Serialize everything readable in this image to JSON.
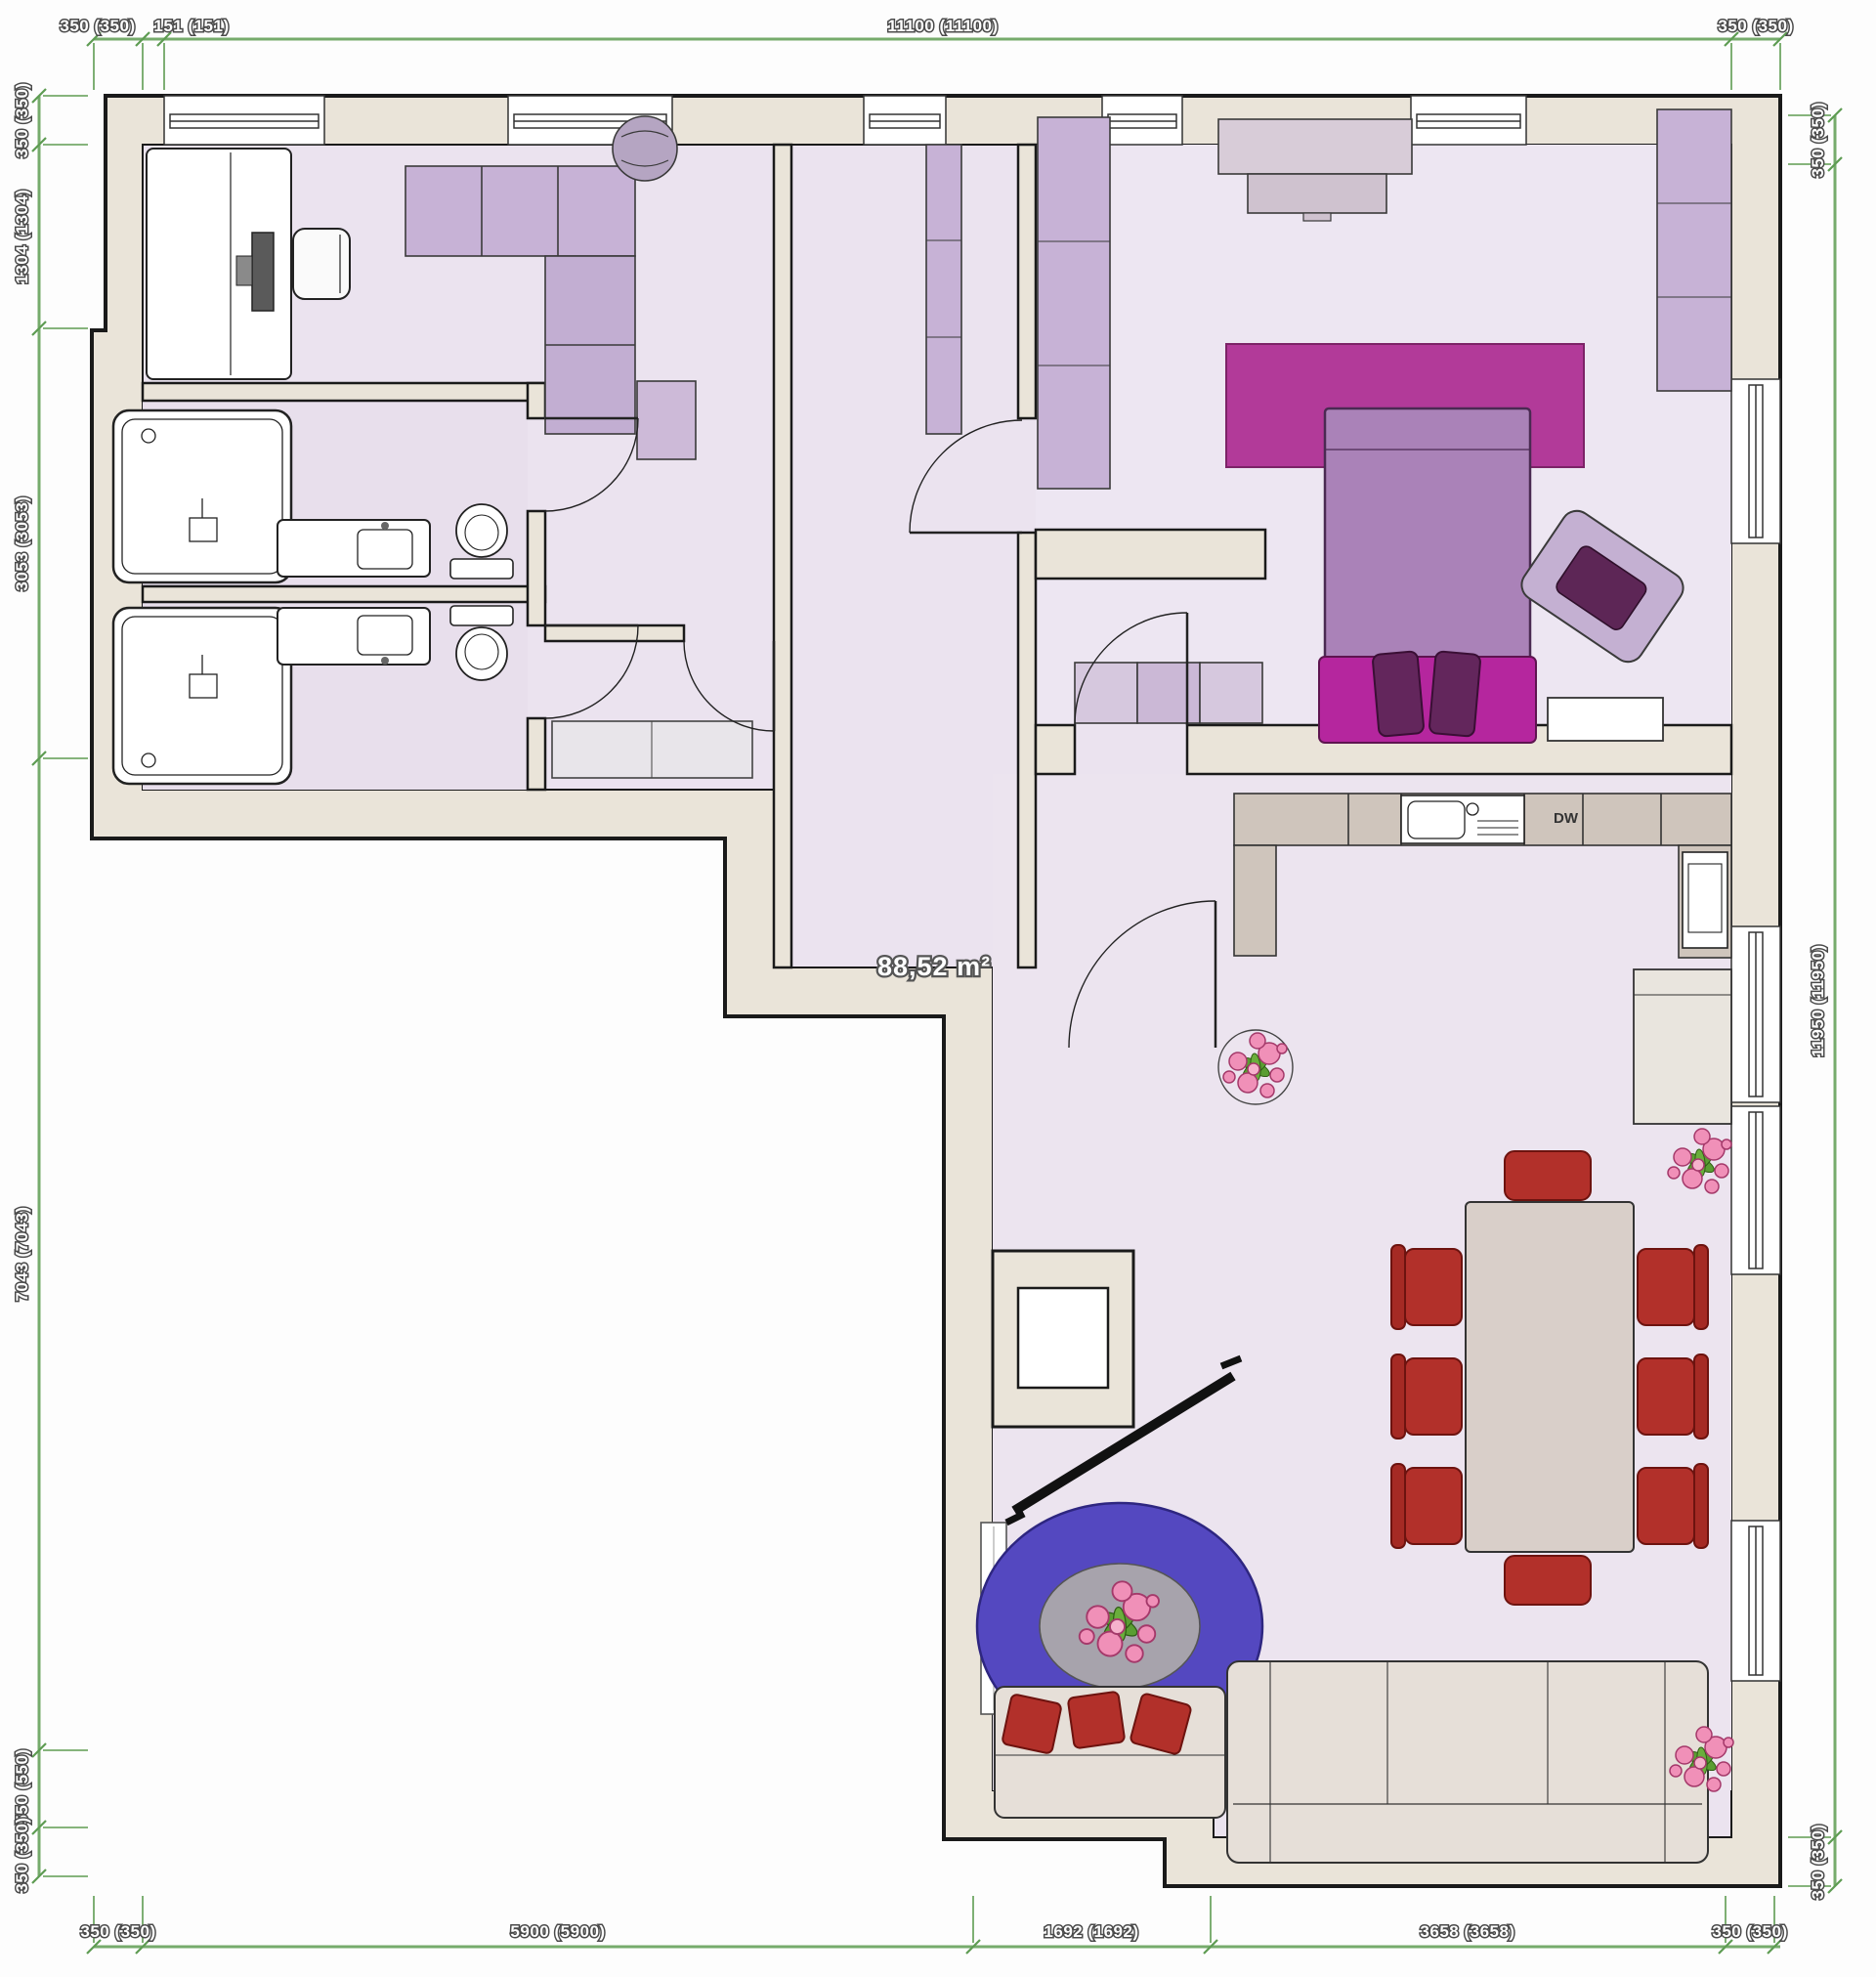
{
  "plan": {
    "area_label": "88,52 m²",
    "appliance_label": "DW",
    "dimensions": {
      "top": [
        "350 (350)",
        "151 (151)",
        "11100 (11100)",
        "350 (350)"
      ],
      "left": [
        "350 (350)",
        "1304 (1304)",
        "3053 (3053)",
        "7043 (7043)",
        "550 (550)",
        "350 (350)"
      ],
      "right": [
        "350 (350)",
        "11950 (11950)",
        "350 (350)"
      ],
      "bottom": [
        "350 (350)",
        "5900 (5900)",
        "1692 (1692)",
        "3658 (3658)",
        "350 (350)"
      ]
    },
    "colors": {
      "wall_fill": "#eae4d9",
      "wall_stroke": "#1a1a1a",
      "floor": "#ebe3ef",
      "furniture_lilac": "#c7b2d6",
      "rug_magenta": "#b23a99",
      "accent_magenta": "#b5269e",
      "bed_purple": "#aa82b8",
      "dark_purple": "#63265c",
      "chair_red": "#b2302a",
      "rug_blue": "#5448c0",
      "counter_taupe": "#cfc5bc",
      "sofa_beige": "#e6dfd8",
      "dimension_green": "#5e9c52",
      "plant_pink": "#f090b8",
      "plant_green": "#5a9e32"
    }
  }
}
